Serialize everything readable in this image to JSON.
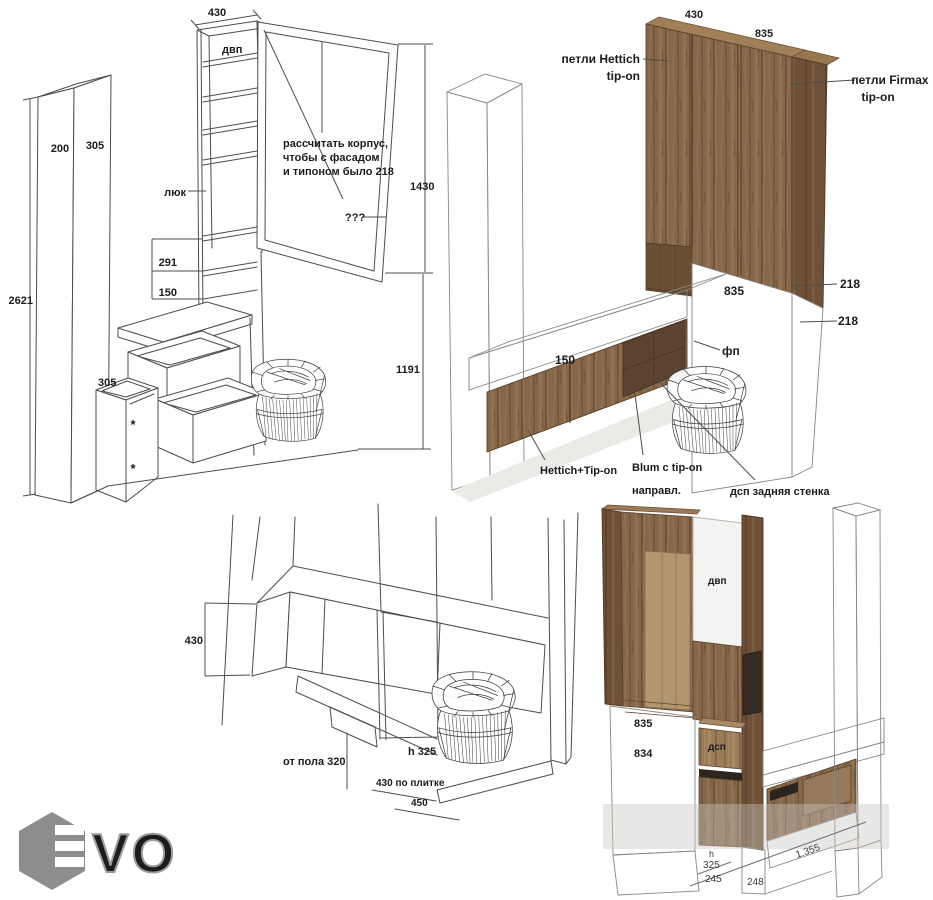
{
  "palette": {
    "line": "#4d4d4d",
    "label": "#1c1c1c",
    "wood": "#86674a",
    "wood_light": "#9b7d5a",
    "wood_dark": "#6e5138",
    "wood_top": "#a28057",
    "marble": "#f7f6f4",
    "gray_panel": "#d8d5d0",
    "slab_top": "#dedbd6",
    "slab_front": "#cbc8c3",
    "accent_dark": "#352c23",
    "logo_gray": "#8d8d8d"
  },
  "views": {
    "sketch_front": {
      "top_width": "430",
      "board": "двп",
      "hatch": "люк",
      "pillar_depth": "200",
      "pillar_width": "305",
      "total_height": "2621",
      "shelf_gap_top": "291",
      "shelf_gap_bottom": "150",
      "box_width": "305",
      "mark_top": "*",
      "mark_bottom": "*",
      "note1": "рассчитать корпус,",
      "note2": "чтобы с фасадом",
      "note3": "и типоном было 218",
      "unknown": "???",
      "upper_height": "1430",
      "lower_height": "1191"
    },
    "render_front": {
      "left_width": "430",
      "right_width": "835",
      "hinge_left1": "петли Hettich",
      "hinge_left2": "tip-on",
      "hinge_right1": "петли Firmax",
      "hinge_right2": "tip-on",
      "back_width": "835",
      "offset_top": "218",
      "offset_bottom": "218",
      "bench_depth": "150",
      "filler": "фп",
      "hinge_note": "Hettich+Tip-on",
      "slide_note1": "Blum с tip-on",
      "slide_note2": "направл.",
      "back_note": "дсп задняя стенка"
    },
    "sketch_bottom": {
      "height": "430",
      "floor_note": "от пола 320",
      "h_note": "h 325",
      "tile_note": "430 по плитке",
      "depth": "450"
    },
    "render_side": {
      "board": "двп",
      "w1": "835",
      "w2": "834",
      "dsp": "дсп",
      "h": "h",
      "h_val": "325",
      "d245": "245",
      "d248": "248",
      "length": "1.355"
    }
  },
  "logo": {
    "letters": "VO"
  }
}
